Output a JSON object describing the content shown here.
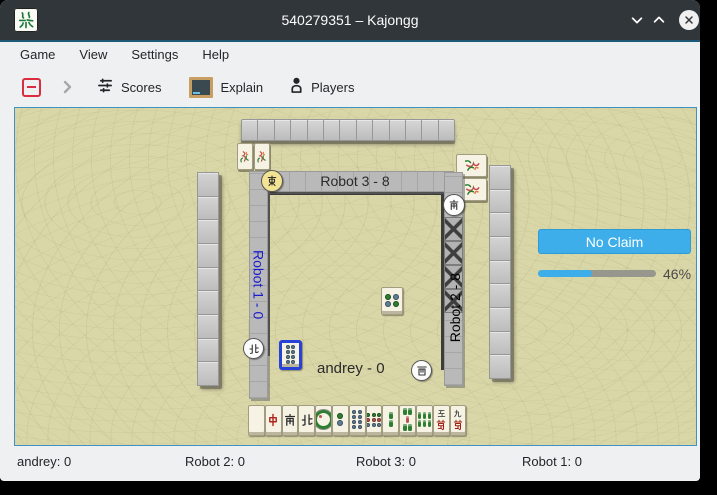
{
  "window": {
    "title": "540279351 – Kajongg",
    "controls": {
      "minimize": "minimize",
      "maximize": "maximize",
      "close": "close"
    }
  },
  "menu": {
    "items": [
      "Game",
      "View",
      "Settings",
      "Help"
    ]
  },
  "toolbar": {
    "scores_label": "Scores",
    "explain_label": "Explain",
    "players_label": "Players"
  },
  "side_panel": {
    "no_claim_label": "No Claim",
    "progress_percent": 46,
    "progress_label": "46%"
  },
  "status_bar": {
    "items": [
      "andrey: 0",
      "Robot 2: 0",
      "Robot 3: 0",
      "Robot 1: 0"
    ]
  },
  "colors": {
    "accent_blue": "#3daee9",
    "titlebar": "#31363b",
    "table_felt": "#d9d6a8",
    "active_player_label": "#1a1acd",
    "highlight_tile_border": "#2742d6",
    "east_disc": "#f2e492"
  },
  "board": {
    "players": {
      "top": {
        "name": "Robot 3",
        "label": "Robot 3 - 8",
        "wind": "E",
        "wind_glyph": "dong",
        "disc": "yellow",
        "bonus_tiles": 2
      },
      "right": {
        "name": "Robot 2",
        "label": "Robot 2 - 8",
        "wind": "S",
        "wind_glyph": "nan",
        "disc": "white",
        "bonus_tiles": 2,
        "concealed_kong_tiles": 4
      },
      "bottom": {
        "name": "andrey",
        "label": "andrey - 0",
        "wind": "W",
        "wind_glyph": "xi",
        "disc": "white"
      },
      "left": {
        "name": "Robot 1",
        "label": "Robot 1 - 0",
        "wind": "N",
        "wind_glyph": "bei",
        "disc": "white",
        "label_color": "#1a1acd"
      }
    },
    "walls": {
      "top": 13,
      "left": 9,
      "right": 9,
      "bottom": 0
    },
    "discards": [
      {
        "id": "circle-4",
        "kind": "circles",
        "rows": [
          [
            "g",
            "s"
          ],
          [
            "s",
            "g"
          ]
        ],
        "slot": "center",
        "highlighted": false
      },
      {
        "id": "circle-8",
        "kind": "circles",
        "rows": [
          [
            "s",
            "s"
          ],
          [
            "s",
            "s"
          ],
          [
            "s",
            "s"
          ],
          [
            "s",
            "s"
          ]
        ],
        "slot": "left",
        "highlighted": true
      }
    ],
    "hand": [
      {
        "id": "white-dragon",
        "kind": "blank"
      },
      {
        "id": "red-dragon",
        "kind": "glyph",
        "glyph": "zhong",
        "color": "#b02318"
      },
      {
        "id": "wind-south",
        "kind": "glyph",
        "glyph": "nan",
        "color": "#2b2b2b"
      },
      {
        "id": "wind-north",
        "kind": "glyph",
        "glyph": "bei",
        "color": "#2b2b2b"
      },
      {
        "id": "circle-1",
        "kind": "circles",
        "big": true,
        "rows": [
          [
            "G"
          ]
        ]
      },
      {
        "id": "circle-2",
        "kind": "circles",
        "rows": [
          [
            "g"
          ],
          [
            "s"
          ]
        ]
      },
      {
        "id": "circle-8",
        "kind": "circles",
        "rows": [
          [
            "s",
            "s"
          ],
          [
            "s",
            "s"
          ],
          [
            "s",
            "s"
          ],
          [
            "s",
            "s"
          ]
        ]
      },
      {
        "id": "circle-9",
        "kind": "circles",
        "rows": [
          [
            "g",
            "g",
            "g"
          ],
          [
            "r",
            "r",
            "r"
          ],
          [
            "s",
            "s",
            "s"
          ]
        ]
      },
      {
        "id": "bamboo-2",
        "kind": "bamboo",
        "rows": [
          [
            "g"
          ],
          [
            "g"
          ]
        ]
      },
      {
        "id": "bamboo-5",
        "kind": "bamboo",
        "rows": [
          [
            "g",
            "g"
          ],
          [
            "r"
          ],
          [
            "g",
            "g"
          ]
        ]
      },
      {
        "id": "bamboo-6",
        "kind": "bamboo",
        "rows": [
          [
            "g",
            "g",
            "g"
          ],
          [
            "g",
            "g",
            "g"
          ]
        ]
      },
      {
        "id": "character-5",
        "kind": "char",
        "top": "wu",
        "glyph": "wan",
        "color": "#a02018"
      },
      {
        "id": "character-9",
        "kind": "char",
        "top": "jiu",
        "glyph": "wan",
        "color": "#a02018"
      }
    ]
  }
}
